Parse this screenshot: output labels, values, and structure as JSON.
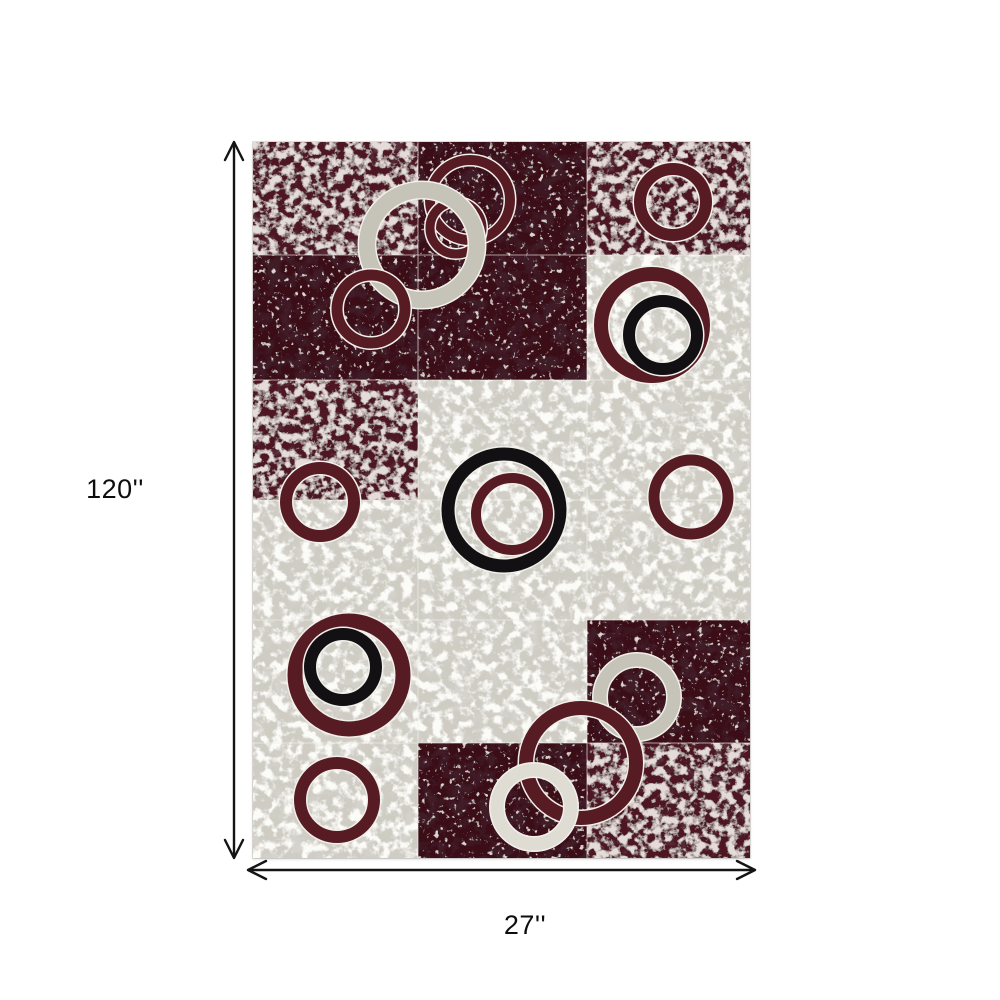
{
  "diagram": {
    "type": "product-dimensions",
    "height_label": "120''",
    "width_label": "27''",
    "arrow_color": "#141414"
  },
  "rug": {
    "description": "checkerboard abstract area rug with marbled red, dark red and gray blocks overlaid with red, black, gray and white rings",
    "colors": {
      "marbled_red": "#4e1820",
      "dark_red": "#3a0f15",
      "light_gray": "#cfccc4",
      "ring_red": "#571b24",
      "ring_black": "#131013",
      "ring_gray": "#c6c3b8",
      "ring_white": "#dedcd3",
      "outline": "#f2f0ea",
      "seam": "rgba(244,242,236,0.5)"
    },
    "cols": [
      0,
      165,
      334,
      497
    ],
    "rows": [
      0,
      113,
      238,
      358,
      478,
      601,
      716
    ],
    "blocks": [
      {
        "r": 0,
        "c": 0,
        "fill": "mr"
      },
      {
        "r": 0,
        "c": 1,
        "fill": "dr"
      },
      {
        "r": 0,
        "c": 2,
        "fill": "mr"
      },
      {
        "r": 1,
        "c": 0,
        "fill": "dr"
      },
      {
        "r": 1,
        "c": 1,
        "fill": "dr"
      },
      {
        "r": 1,
        "c": 2,
        "fill": "lg"
      },
      {
        "r": 2,
        "c": 0,
        "fill": "mr"
      },
      {
        "r": 2,
        "c": 1,
        "fill": "lg"
      },
      {
        "r": 2,
        "c": 2,
        "fill": "lg"
      },
      {
        "r": 3,
        "c": 0,
        "fill": "lg"
      },
      {
        "r": 3,
        "c": 1,
        "fill": "lg"
      },
      {
        "r": 3,
        "c": 2,
        "fill": "lg"
      },
      {
        "r": 4,
        "c": 0,
        "fill": "lg"
      },
      {
        "r": 4,
        "c": 1,
        "fill": "lg"
      },
      {
        "r": 4,
        "c": 2,
        "fill": "dr"
      },
      {
        "r": 5,
        "c": 0,
        "fill": "lg"
      },
      {
        "r": 5,
        "c": 1,
        "fill": "dr"
      },
      {
        "r": 5,
        "c": 2,
        "fill": "mr"
      }
    ],
    "rings": [
      {
        "name": "top-red-ring-outer",
        "cx": 217,
        "cy": 58,
        "r": 40,
        "sw": 10,
        "color": "red"
      },
      {
        "name": "top-red-ring-inner",
        "cx": 203,
        "cy": 86,
        "r": 26,
        "sw": 9,
        "color": "red"
      },
      {
        "name": "big-gray-ring",
        "cx": 169,
        "cy": 103,
        "r": 55,
        "sw": 16,
        "color": "gray"
      },
      {
        "name": "left-upper-red-ring",
        "cx": 118,
        "cy": 167,
        "r": 34,
        "sw": 11,
        "color": "red"
      },
      {
        "name": "top-right-red-ring",
        "cx": 420,
        "cy": 60,
        "r": 33,
        "sw": 12,
        "color": "red"
      },
      {
        "name": "right-red-ring",
        "cx": 399,
        "cy": 183,
        "r": 51,
        "sw": 14,
        "color": "red"
      },
      {
        "name": "right-black-ring",
        "cx": 410,
        "cy": 193,
        "r": 34,
        "sw": 12,
        "color": "black"
      },
      {
        "name": "center-black-ring",
        "cx": 251,
        "cy": 368,
        "r": 56,
        "sw": 13,
        "color": "black"
      },
      {
        "name": "center-red-ring",
        "cx": 259,
        "cy": 372,
        "r": 36,
        "sw": 10,
        "color": "red"
      },
      {
        "name": "right-mid-red-ring",
        "cx": 438,
        "cy": 355,
        "r": 37,
        "sw": 11,
        "color": "red"
      },
      {
        "name": "left-mid-red-ring",
        "cx": 67,
        "cy": 360,
        "r": 34,
        "sw": 12,
        "color": "red"
      },
      {
        "name": "lower-left-red-ring",
        "cx": 96,
        "cy": 533,
        "r": 54,
        "sw": 15,
        "color": "red"
      },
      {
        "name": "lower-left-black-ring",
        "cx": 90,
        "cy": 525,
        "r": 33,
        "sw": 12,
        "color": "black"
      },
      {
        "name": "bottom-left-red-ring",
        "cx": 84,
        "cy": 658,
        "r": 37,
        "sw": 12,
        "color": "red"
      },
      {
        "name": "cluster-gray-ring",
        "cx": 384,
        "cy": 555,
        "r": 37,
        "sw": 13,
        "color": "gray"
      },
      {
        "name": "cluster-red-ring",
        "cx": 328,
        "cy": 621,
        "r": 55,
        "sw": 14,
        "color": "red"
      },
      {
        "name": "cluster-white-ring",
        "cx": 281,
        "cy": 665,
        "r": 37,
        "sw": 13,
        "color": "white"
      }
    ]
  }
}
